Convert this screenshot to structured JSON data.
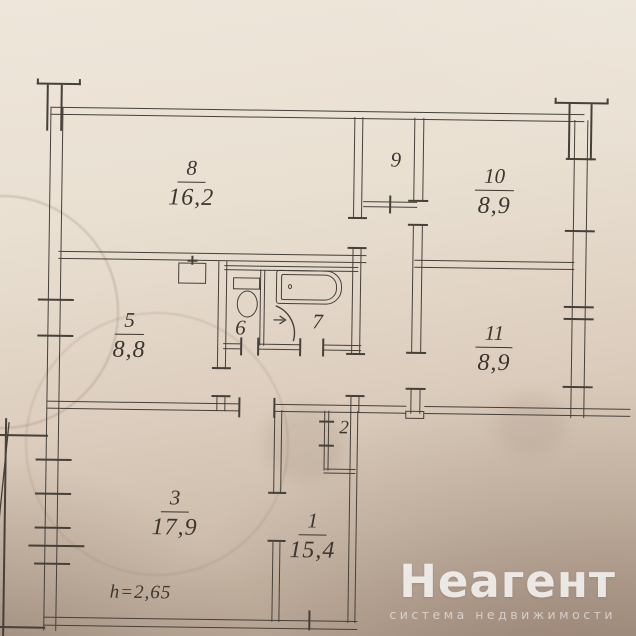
{
  "plan": {
    "rooms": [
      {
        "number": "8",
        "area": "16,2"
      },
      {
        "number": "9",
        "area": ""
      },
      {
        "number": "10",
        "area": "8,9"
      },
      {
        "number": "5",
        "area": "8,8"
      },
      {
        "number": "6",
        "area": ""
      },
      {
        "number": "7",
        "area": ""
      },
      {
        "number": "11",
        "area": "8,9"
      },
      {
        "number": "2",
        "area": ""
      },
      {
        "number": "3",
        "area": "17,9"
      },
      {
        "number": "1",
        "area": "15,4"
      }
    ],
    "ceiling_height_label": "h=2,65"
  },
  "watermark": {
    "brand": "Неагент",
    "tagline": "система недвижимости"
  },
  "colors": {
    "ink": "#46403a",
    "paper": "#e8dfd1",
    "watermark_text": "#ffffff"
  }
}
